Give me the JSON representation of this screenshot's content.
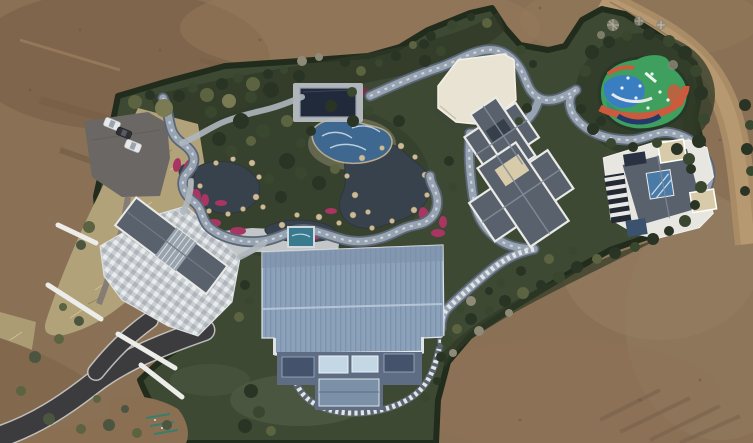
{
  "scene": {
    "type": "aerial-drone-photo",
    "description": "Top-down aerial view of a landscaped private estate: garden ponds with rockeries and magenta flower beds, a winding blue-gray pathway, a dark pool-cover panel, a wave-mosaic pool, a white flat-roof pavilion, a colorful children playground, two gray-roof villas, a large blue corrugated-roof hall, a stone plaza with entrance building, a parking area with cars, asphalt driveway, all surrounded by bare brown earth and a dirt road.",
    "counts": {
      "cars": 3,
      "villas": 2,
      "ponds": 3
    },
    "objects": [
      "dirt-ground",
      "dirt-road",
      "boundary-hedge",
      "lawn",
      "dry-grass-bank",
      "driveway",
      "parking-lot",
      "car",
      "entrance-building",
      "stone-plaza",
      "pergola-beams",
      "garden-pond",
      "stone-path",
      "wave-pool",
      "pool-cover-panel",
      "flower-bed",
      "rockery",
      "winding-track",
      "stair-path",
      "white-pavilion",
      "playground",
      "villa-center",
      "villa-east",
      "blue-roof-hall",
      "rooftop-spa",
      "stepping-stone-path",
      "shrubs",
      "bare-trees",
      "paint-marks"
    ]
  },
  "colors": {
    "dirt_base": "#8a7156",
    "dirt_dark": "#73593f",
    "dirt_light": "#95795a",
    "dirt_overlay": "#82684c",
    "dirt_patch": "#8a6f52",
    "dirt_road": "#a98c66",
    "dirt_road_center": "#b79a72",
    "scrub_tan": "#b2a279",
    "scrub_tan_left": "#ab9c74",
    "lawn": "#3e4934",
    "lawn_light": "#4e5a42",
    "hedge": "#222c1d",
    "garden_mass": "#2f3927",
    "tree_dark": "#2a3424",
    "tree_mid": "#3a472f",
    "tree_olive": "#5c6340",
    "tree_light": "#7a7b52",
    "tree_bare": "#8f8a78",
    "tree_gray": "#4b5540",
    "path_stone": "#aeb6bd",
    "plaza": "#c9ced2",
    "water_dark": "#38424d",
    "pool_blue": "#3e6890",
    "sand": "#b9ab8d",
    "track_fill": "#97a3b1",
    "track_edge": "#5a6675",
    "track_dash": "#ccd3da",
    "flower_magenta": "#a93562",
    "flower_dark_red": "#7e2d44",
    "rock_tan": "#cdbb97",
    "roof_dark": "#59616d",
    "roof_trim": "#e9e9e6",
    "roof_tan_flat": "#d8cbaa",
    "roof_ridge": "#868f9c",
    "navy_panel": "#202a3a",
    "blue_roof": "#8ca2bb",
    "blue_roof_dark": "#7e94ad",
    "facade": "#5e6d83",
    "window_light": "#c3d7e5",
    "window_dark": "#44536b",
    "window_glass": "#7b91a8",
    "white_roof": "#e9e3d3",
    "asphalt": "#3c3b3d",
    "asphalt_edge": "#c8c8c6",
    "parking": "#6b6765",
    "car_white": "#e8e8ea",
    "car_dark": "#2e3033",
    "playground_green": "#3f9f5e",
    "playground_teal": "#2f9180",
    "playground_blue": "#3a7ec2",
    "playground_red": "#cc5a3c",
    "playground_navy": "#23386b",
    "spa_teal": "#3a7a8e",
    "paint_teal": "#2f8070",
    "skylight_blue": "#4a7ba6"
  }
}
